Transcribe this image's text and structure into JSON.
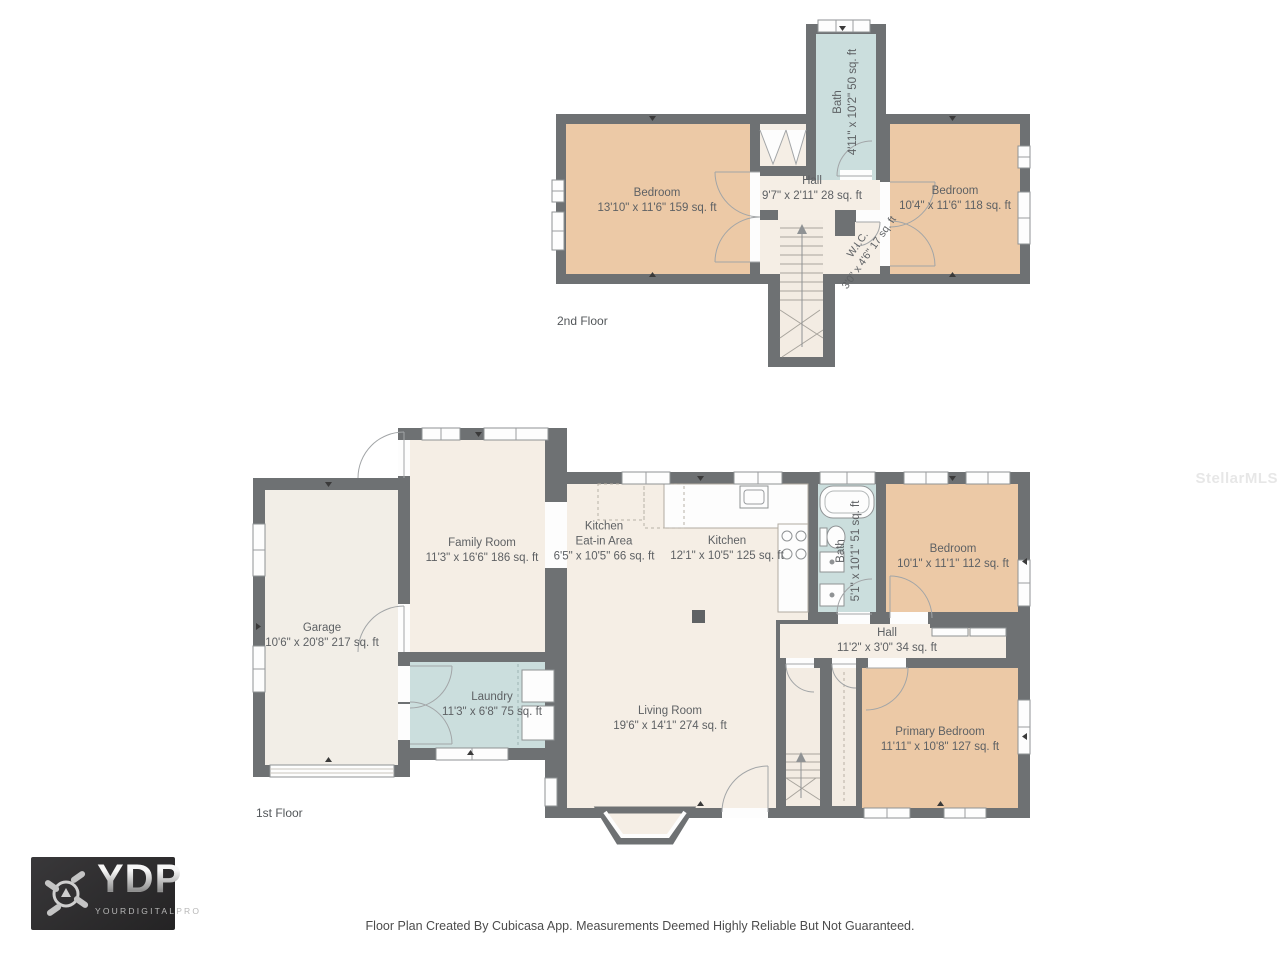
{
  "watermark": "StellarMLS",
  "footer": "Floor Plan Created By Cubicasa App. Measurements Deemed Highly Reliable But Not Guaranteed.",
  "logo": {
    "abbr": "YDP",
    "name": "YOURDIGITALPRO"
  },
  "colors": {
    "wall": "#6e7173",
    "room_cream": "#f5eee5",
    "garage_floor": "#f2eee7",
    "bedroom_tan": "#ecc9a6",
    "wet_blue": "#cbdedd",
    "label_text": "#5e6164"
  },
  "floors": {
    "second": {
      "label": "2nd Floor",
      "rooms": {
        "bedroom_left": {
          "name": "Bedroom",
          "dims": "13'10\" x 11'6\" 159 sq. ft"
        },
        "hall": {
          "name": "Hall",
          "dims": "9'7\" x 2'11\" 28 sq. ft"
        },
        "bath": {
          "name": "Bath",
          "dims": "4'11\" x 10'2\" 50 sq. ft"
        },
        "bedroom_right": {
          "name": "Bedroom",
          "dims": "10'4\" x 11'6\" 118 sq. ft"
        },
        "wic": {
          "name": "W.I.C.",
          "dims": "3'0\" x 4'6\" 17 sq. ft"
        }
      }
    },
    "first": {
      "label": "1st Floor",
      "rooms": {
        "garage": {
          "name": "Garage",
          "dims": "10'6\" x 20'8\" 217 sq. ft"
        },
        "family": {
          "name": "Family Room",
          "dims": "11'3\" x 16'6\" 186 sq. ft"
        },
        "eat_in": {
          "name": "Kitchen",
          "name2": "Eat-in Area",
          "dims": "6'5\" x 10'5\" 66 sq. ft"
        },
        "kitchen": {
          "name": "Kitchen",
          "dims": "12'1\" x 10'5\" 125 sq. ft"
        },
        "bath": {
          "name": "Bath",
          "dims": "5'1\" x 10'1\" 51 sq. ft"
        },
        "bedroom": {
          "name": "Bedroom",
          "dims": "10'1\" x 11'1\" 112 sq. ft"
        },
        "hall": {
          "name": "Hall",
          "dims": "11'2\" x 3'0\" 34 sq. ft"
        },
        "laundry": {
          "name": "Laundry",
          "dims": "11'3\" x 6'8\" 75 sq. ft"
        },
        "living": {
          "name": "Living Room",
          "dims": "19'6\" x 14'1\" 274 sq. ft"
        },
        "primary": {
          "name": "Primary Bedroom",
          "dims": "11'11\" x 10'8\" 127 sq. ft"
        }
      }
    }
  }
}
